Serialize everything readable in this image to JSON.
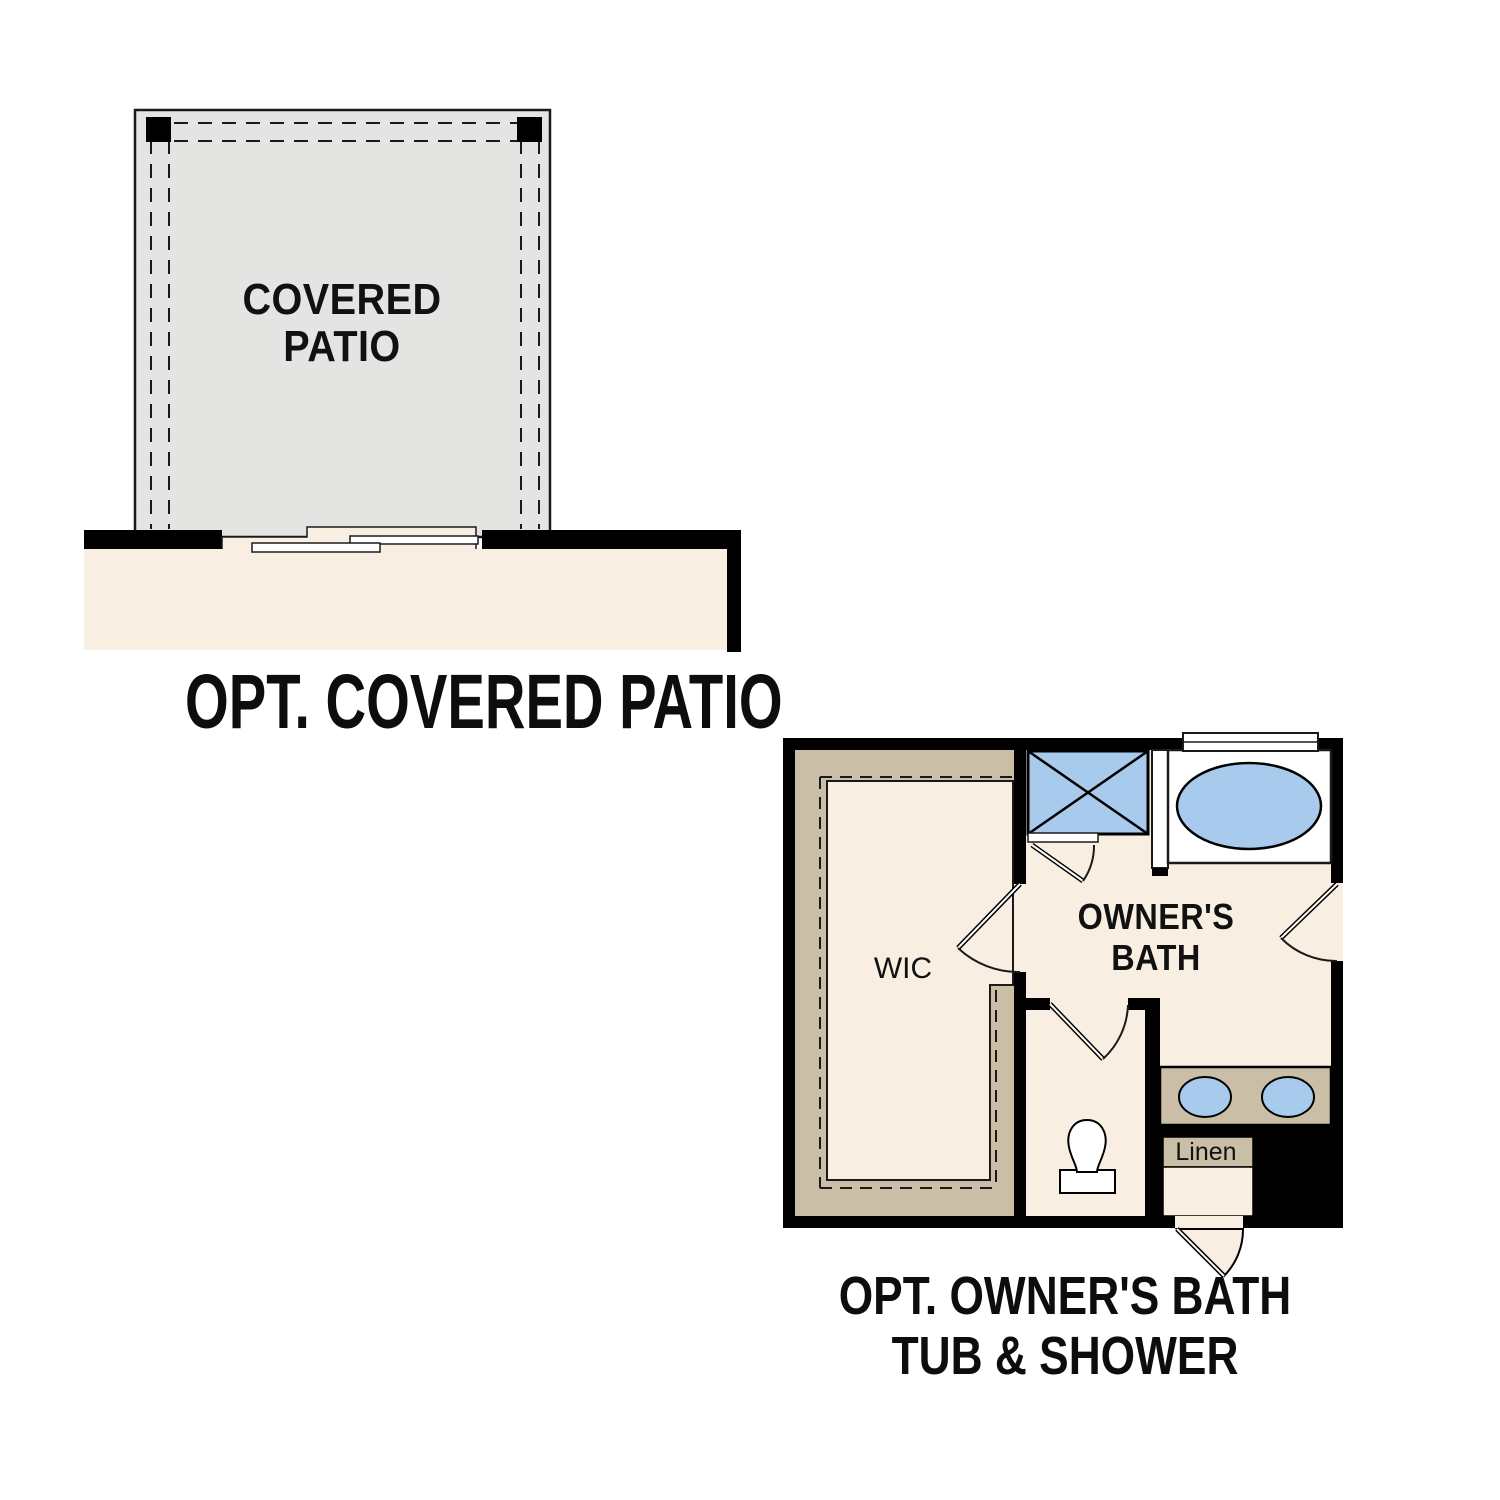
{
  "page": {
    "background": "#ffffff"
  },
  "colors": {
    "wall": "#000000",
    "line": "#1a1a1a",
    "cream": "#f8efe2",
    "tan": "#cabea6",
    "blue": "#a8caec",
    "patio": "#e4e4e2",
    "paper": "#ffffff"
  },
  "patio_plan": {
    "room_label_line1": "COVERED",
    "room_label_line2": "PATIO",
    "caption": "OPT. COVERED PATIO",
    "icons": [
      "patio-slab",
      "roof-overhang-dashed-lines",
      "corner-post",
      "sliding-glass-door",
      "house-wall"
    ]
  },
  "bath_plan": {
    "wic_label": "WIC",
    "room_label_line1": "OWNER'S",
    "room_label_line2": "BATH",
    "linen_label": "Linen",
    "caption_line1": "OPT. OWNER'S BATH",
    "caption_line2": "TUB & SHOWER",
    "icons": [
      "shower",
      "tub",
      "window",
      "double-vanity-sinks",
      "toilet",
      "linen-closet",
      "door-swing",
      "closet-shelving-dashed-rod"
    ]
  }
}
